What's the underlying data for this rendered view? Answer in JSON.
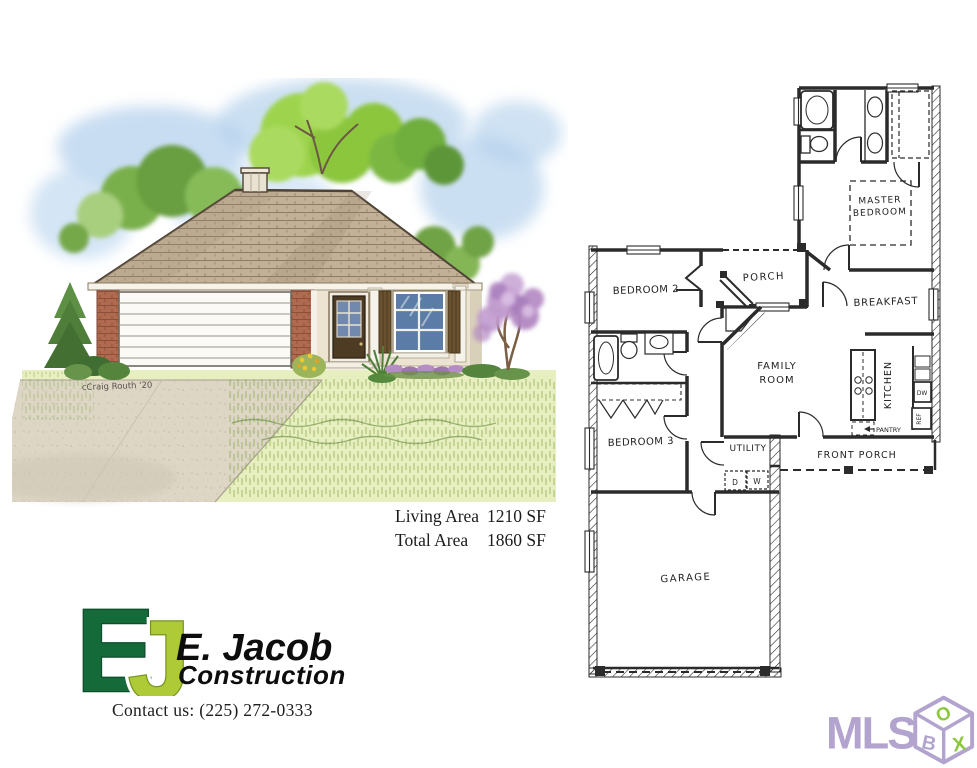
{
  "illustration": {
    "signature": "cCraig Routh '20"
  },
  "floorplan": {
    "ink": "#2b2b2b",
    "labels": {
      "master_line1": "MASTER",
      "master_line2": "BEDROOM",
      "porch": "PORCH",
      "bedroom2": "BEDROOM 2",
      "breakfast": "BREAKFAST",
      "family_line1": "FAMILY",
      "family_line2": "ROOM",
      "kitchen": "KITCHEN",
      "pantry": "PANTRY",
      "bedroom3": "BEDROOM 3",
      "utility": "UTILITY",
      "front_porch": "FRONT PORCH",
      "garage": "GARAGE",
      "dryer": "D",
      "washer": "W",
      "ref": "REF",
      "dishwasher": "DW"
    }
  },
  "areas": {
    "living_label": "Living Area",
    "living_value": "1210 SF",
    "total_label": "Total Area",
    "total_value": "1860 SF"
  },
  "logo": {
    "monogram_e": "E",
    "monogram_j": "J",
    "company": "E. Jacob",
    "tagline": "Construction",
    "contact": "Contact us: (225) 272-0333",
    "colors": {
      "e_green": "#156a39",
      "j_green": "#aecb37"
    }
  },
  "mls": {
    "text": "MLS",
    "box_b": "B",
    "box_o": "O",
    "box_x": "X",
    "purple": "#b2a4ce",
    "green": "#8dc63f"
  }
}
